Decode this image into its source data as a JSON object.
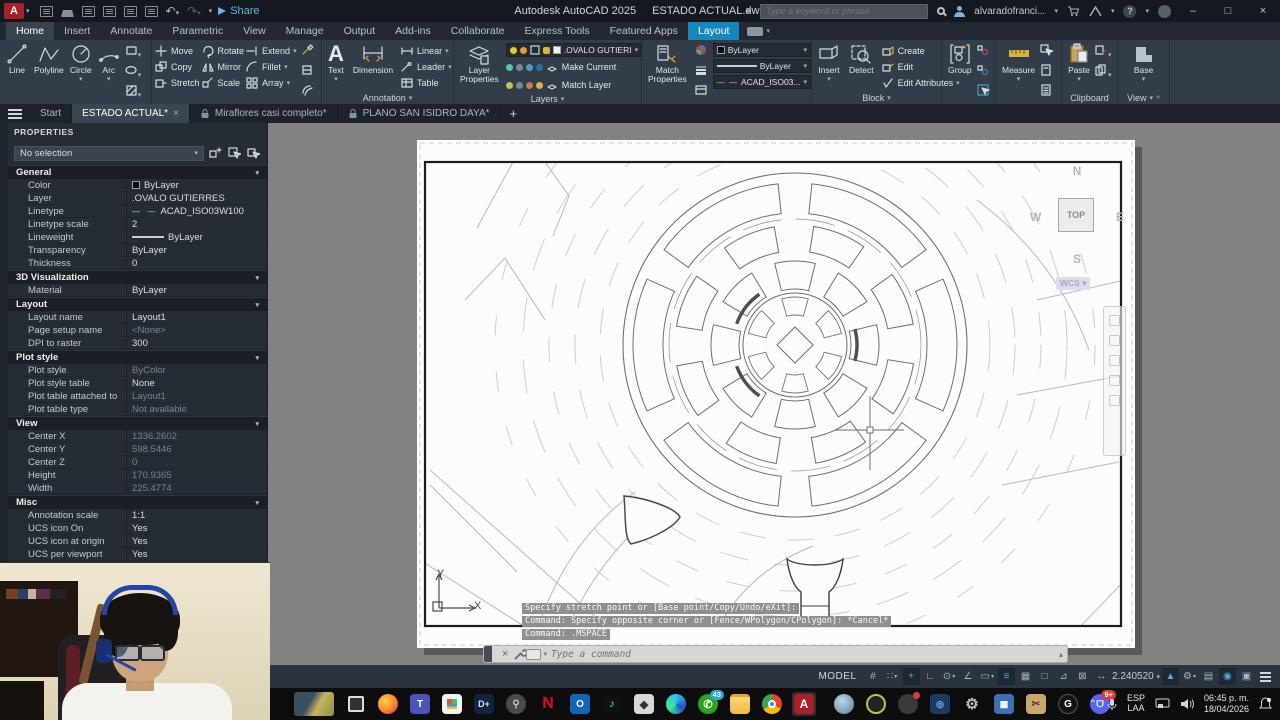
{
  "titlebar": {
    "app_title": "Autodesk AutoCAD 2025",
    "doc_title": "ESTADO ACTUAL.dwg",
    "share_label": "Share",
    "search_placeholder": "Type a keyword or phrase",
    "account_name": "alvaradofranci...",
    "window": {
      "minimize": "–",
      "maximize": "□",
      "close": "×"
    }
  },
  "ribbon": {
    "tabs": [
      "Home",
      "Insert",
      "Annotate",
      "Parametric",
      "View",
      "Manage",
      "Output",
      "Add-ins",
      "Collaborate",
      "Express Tools",
      "Featured Apps",
      "Layout"
    ],
    "panels": {
      "draw": {
        "label": "Draw",
        "line": "Line",
        "polyline": "Polyline",
        "circle": "Circle",
        "arc": "Arc"
      },
      "modify": {
        "label": "Modify",
        "move": "Move",
        "rotate": "Rotate",
        "extend": "Extend",
        "copy": "Copy",
        "mirror": "Mirror",
        "fillet": "Fillet",
        "stretch": "Stretch",
        "scale": "Scale",
        "array": "Array"
      },
      "annotation": {
        "label": "Annotation",
        "text": "Text",
        "dimension": "Dimension",
        "linear": "Linear",
        "leader": "Leader",
        "table": "Table"
      },
      "layers": {
        "label": "Layers",
        "layer_properties": "Layer Properties",
        "layer_value": ".OVALO GUTIERI",
        "make_current": "Make Current",
        "match_layer": "Match Layer"
      },
      "properties": {
        "label": "Properties",
        "match_properties": "Match Properties",
        "color": "ByLayer",
        "lineweight": "ByLayer",
        "linetype": "ACAD_ISO03..."
      },
      "block": {
        "label": "Block",
        "insert": "Insert",
        "detect": "Detect",
        "create": "Create",
        "edit": "Edit",
        "edit_attributes": "Edit Attributes"
      },
      "groups": {
        "label": "Groups",
        "group": "Group"
      },
      "utilities": {
        "label": "Utilities",
        "measure": "Measure"
      },
      "clipboard": {
        "label": "Clipboard",
        "paste": "Paste"
      },
      "view": {
        "label": "View",
        "base": "Base"
      }
    }
  },
  "file_tabs": {
    "start": "Start",
    "tab_active": "ESTADO ACTUAL*",
    "tab2": "Miraflores casi completo*",
    "tab3": "PLANO SAN ISIDRO DAYA*",
    "new_tab": "+"
  },
  "palette": {
    "title": "PROPERTIES",
    "selector": "No selection",
    "sections": [
      {
        "name": "General",
        "rows": [
          [
            "Color",
            "ByLayer"
          ],
          [
            "Layer",
            ".OVALO GUTIERRES"
          ],
          [
            "Linetype",
            "ACAD_ISO03W100"
          ],
          [
            "Linetype scale",
            "2"
          ],
          [
            "Lineweight",
            "ByLayer"
          ],
          [
            "Transparency",
            "ByLayer"
          ],
          [
            "Thickness",
            "0"
          ]
        ]
      },
      {
        "name": "3D Visualization",
        "rows": [
          [
            "Material",
            "ByLayer"
          ]
        ]
      },
      {
        "name": "Layout",
        "rows": [
          [
            "Layout name",
            "Layout1"
          ],
          [
            "Page setup name",
            "<None>"
          ],
          [
            "DPI to raster",
            "300"
          ]
        ]
      },
      {
        "name": "Plot style",
        "rows": [
          [
            "Plot style",
            "ByColor"
          ],
          [
            "Plot style table",
            "None"
          ],
          [
            "Plot table attached to",
            "Layout1"
          ],
          [
            "Plot table type",
            "Not available"
          ]
        ]
      },
      {
        "name": "View",
        "rows": [
          [
            "Center X",
            "1336.2602"
          ],
          [
            "Center Y",
            "598.5446"
          ],
          [
            "Center Z",
            "0"
          ],
          [
            "Height",
            "170.9365"
          ],
          [
            "Width",
            "225.4774"
          ]
        ]
      },
      {
        "name": "Misc",
        "rows": [
          [
            "Annotation scale",
            "1:1"
          ],
          [
            "UCS icon On",
            "Yes"
          ],
          [
            "UCS icon at origin",
            "Yes"
          ],
          [
            "UCS per viewport",
            "Yes"
          ]
        ]
      }
    ]
  },
  "viewport": {
    "viewcube": {
      "n": "N",
      "w": "W",
      "e": "E",
      "s": "S",
      "top": "TOP",
      "wcs": "WCS"
    },
    "ucs": {
      "x": "X",
      "y": "Y"
    }
  },
  "command": {
    "history": [
      "Specify stretch point or [Base point/Copy/Undo/eXit]:",
      "Command: Specify opposite corner or [Fence/WPolygon/CPolygon]: *Cancel*",
      "Command:  .MSPACE"
    ],
    "placeholder": "Type a command"
  },
  "statusbar": {
    "model": "MODEL",
    "scale_value": "2.240520"
  },
  "taskbar": {
    "whatsapp_badge": "43",
    "discord_badge": "9+",
    "lang_top": "ESP",
    "lang_bottom": "LAA",
    "time": "06:45 p. m.",
    "date": "18/04/2026"
  },
  "colors": {
    "active_tab_blue": "#1587bd",
    "autocad_red": "#ab1f29",
    "share_blue": "#62b6e8",
    "measure_yellow": "#d9b33c",
    "whatsapp_green": "#27a61b",
    "discord_purple": "#5865f2",
    "paper_white": "#fcfcfc",
    "canvas_gray": "#828282"
  }
}
